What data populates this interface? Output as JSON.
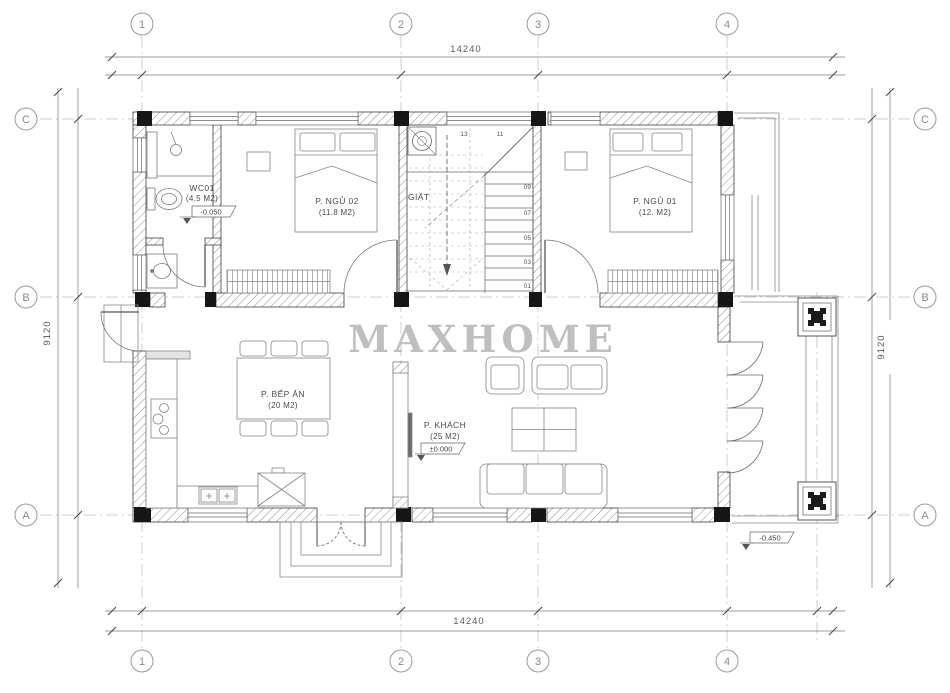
{
  "watermark": "MAXHOME",
  "grid": {
    "cols": [
      "1",
      "2",
      "3",
      "4"
    ],
    "rows": [
      "C",
      "B",
      "A"
    ]
  },
  "dims": {
    "top": "14240",
    "bottom": "14240",
    "left": "9120",
    "right": "9120"
  },
  "rooms": {
    "wc": {
      "name": "WC01",
      "area": "(4.5 M2)",
      "elevation": "-0.050"
    },
    "bedroom2": {
      "name": "P. NGỦ 02",
      "area": "(11.8 M2)"
    },
    "bedroom1": {
      "name": "P. NGỦ 01",
      "area": "(12. M2)"
    },
    "kitchen": {
      "name": "P. BẾP ĂN",
      "area": "(20 M2)"
    },
    "living": {
      "name": "P. KHÁCH",
      "area": "(25 M2)",
      "elevation": "±0.000"
    },
    "laundry": {
      "name": "GIẶT"
    },
    "porch": {
      "elevation": "-0.450"
    }
  },
  "stairs": {
    "numbers": [
      "01",
      "03",
      "05",
      "07",
      "09",
      "11",
      "13"
    ]
  },
  "colors": {
    "line": "#3d3d3d",
    "centerline": "#c0c0c0",
    "watermark": "#b5b5b5"
  }
}
